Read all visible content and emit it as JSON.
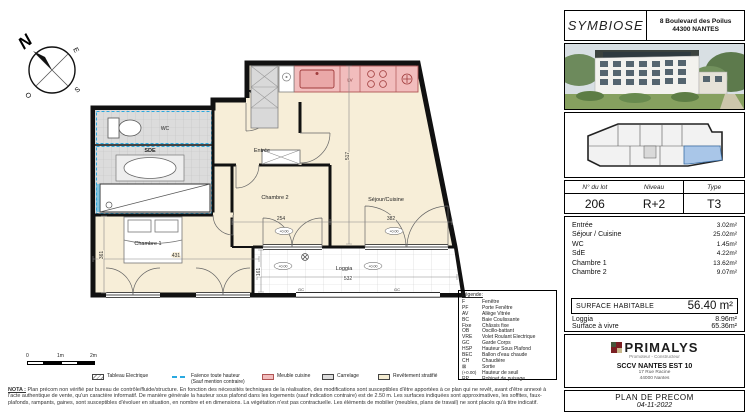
{
  "compass": {
    "n": "N",
    "e": "E",
    "s": "S",
    "o": "O"
  },
  "plan": {
    "room_labels": {
      "wc": "WC",
      "sde": "SDE",
      "entree": "Entrée",
      "chambre2": "Chambre 2",
      "sejour": "Séjour/Cuisine",
      "chambre1": "Chambre 1",
      "loggia": "Loggia"
    },
    "dims": {
      "chambre2_width": "254",
      "sejour_width": "382",
      "chambre1_width": "431",
      "loggia_width": "532",
      "sejour_height": "517",
      "chambre1_height": "361",
      "loggia_height": "161"
    },
    "annotations": {
      "lv": "LV",
      "gc": "GC",
      "seuil": "+0.00"
    }
  },
  "scale_bar": {
    "zero": "0",
    "one": "1m",
    "two": "2m"
  },
  "materials_legend": [
    {
      "label": "Tableau Electrique"
    },
    {
      "label": "Faïence toute hauteur",
      "sublabel": "(Sauf mention contraire)"
    },
    {
      "label": "Meuble cuisine"
    },
    {
      "label": "Carrelage"
    },
    {
      "label": "Revêtement stratifié"
    }
  ],
  "legend_box": {
    "title": "Légende:",
    "items": [
      {
        "abbr": "F",
        "label": "Fenêtre"
      },
      {
        "abbr": "PF",
        "label": "Porte Fenêtre"
      },
      {
        "abbr": "AV",
        "label": "Allège Vitrée"
      },
      {
        "abbr": "BC",
        "label": "Baie Coulissante"
      },
      {
        "abbr": "Fixe",
        "label": "Châssis fixe"
      },
      {
        "abbr": "OB",
        "label": "Oscillo-battant"
      },
      {
        "abbr": "VRE",
        "label": "Volet Roulant Electrique"
      },
      {
        "abbr": "GC",
        "label": "Garde Corps"
      },
      {
        "abbr": "HSP",
        "label": "Hauteur Sous Plafond"
      },
      {
        "abbr": "BEC",
        "label": "Ballon d'eau chaude"
      },
      {
        "abbr": "CH",
        "label": "Chaudière"
      },
      {
        "abbr": "⊠",
        "label": "Sortie"
      },
      {
        "abbr": "(+0.00)",
        "label": "Hauteur de seuil"
      },
      {
        "abbr": "RP",
        "label": "Robinet de puisage"
      }
    ]
  },
  "nota": {
    "heading": "NOTA :",
    "line1": "Plan précom non vérifié par bureau de contrôle/fluide/structure. En fonction des nécessités techniques de la réalisation, des modifications sont susceptibles d'être apportées à ce plan qui ne revêt, avant d'être annexé à",
    "line2": "l'acte authentique de vente, qu'un caractère informatif. De manière générale la hauteur sous plafond dans les logements (sauf indication contraire) est de 2.50 m. Les surfaces indiquées sont approximatives, les soffites,",
    "line3": "faux-plafonds, rampants, gaines, sont susceptibles d'évoluer en situation, en nombre et en dimensions. La végétation n'est pas contractuelle. Les éléments de mobilier (meubles, plans de travail) ne sont placés qu'à titre indicatif."
  },
  "panel": {
    "project_name": "SYMBIOSE",
    "address_line1": "8 Boulevard des Poilus",
    "address_line2": "44300 NANTES",
    "lot": {
      "col1_header": "N° du lot",
      "col2_header": "Niveau",
      "col3_header": "Type",
      "col1_value": "206",
      "col2_value": "R+2",
      "col3_value": "T3"
    },
    "areas": [
      {
        "label": "Entrée",
        "value": "3.02m²"
      },
      {
        "label": "Séjour / Cuisine",
        "value": "25.02m²"
      },
      {
        "label": "WC",
        "value": "1.45m²"
      },
      {
        "label": "SdE",
        "value": "4.22m²"
      },
      {
        "label": "Chambre 1",
        "value": "13.62m²"
      },
      {
        "label": "Chambre 2",
        "value": "9.07m²"
      }
    ],
    "surface_habitable": {
      "label": "SURFACE HABITABLE",
      "value": "56.40 m²"
    },
    "loggia": {
      "label": "Loggia",
      "value": "8.96m²"
    },
    "surface_a_vivre": {
      "label": "Surface à vivre",
      "value": "65.36m²"
    },
    "brand": {
      "name": "PRIMALYS",
      "tagline": "Promoteur - Constructeur"
    },
    "company": {
      "name": "SCCV NANTES EST 10",
      "address_line1": "17 Rue Racine",
      "address_line2": "44000 Nantes"
    },
    "document": {
      "title": "PLAN DE PRECOM",
      "date": "04-11-2022"
    }
  },
  "colors": {
    "accent_blue": "#2aa9e0",
    "kitchen_pink": "#f2bdbd",
    "keyplan_highlight": "#a9c6e8",
    "floor_beige": "#f7eed8",
    "tile_gray": "#dcdcdc"
  }
}
